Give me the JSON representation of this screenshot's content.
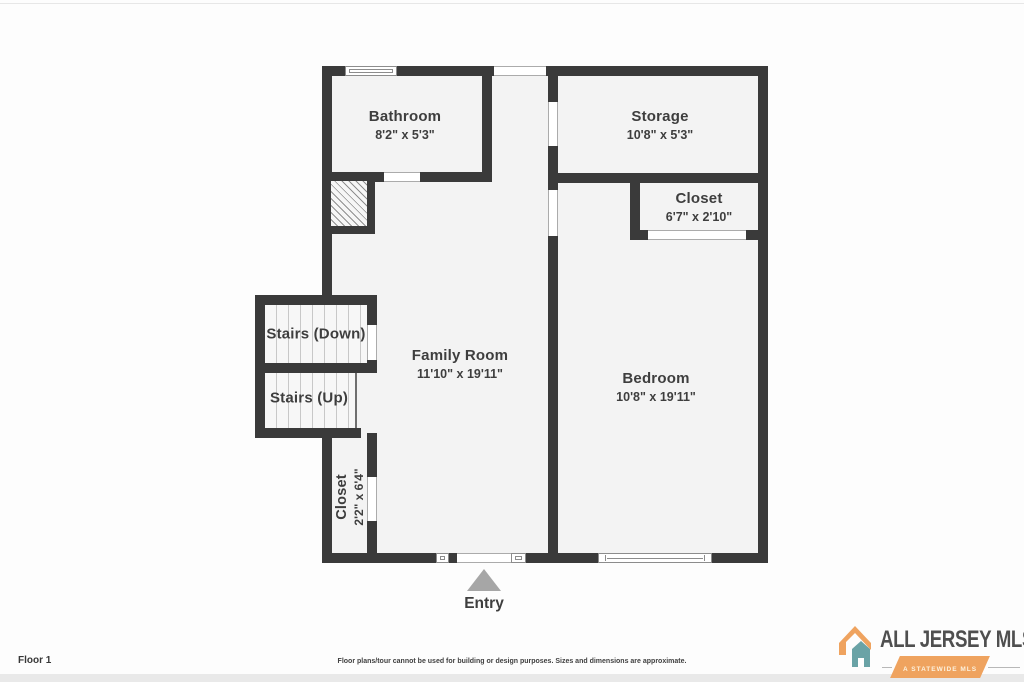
{
  "plan": {
    "entry_label": "Entry"
  },
  "rooms": {
    "bathroom": {
      "name": "Bathroom",
      "dims": "8'2\" x 5'3\""
    },
    "storage": {
      "name": "Storage",
      "dims": "10'8\" x 5'3\""
    },
    "closet_right": {
      "name": "Closet",
      "dims": "6'7\" x 2'10\""
    },
    "family_room": {
      "name": "Family Room",
      "dims": "11'10\" x 19'11\""
    },
    "bedroom": {
      "name": "Bedroom",
      "dims": "10'8\" x 19'11\""
    },
    "stairs_down": {
      "name": "Stairs (Down)"
    },
    "stairs_up": {
      "name": "Stairs (Up)"
    },
    "closet_left": {
      "name": "Closet",
      "dims": "2'2\" x 6'4\""
    }
  },
  "footer": {
    "floor_label": "Floor 1",
    "disclaimer": "Floor plans/tour cannot be used for building or design purposes. Sizes and dimensions are approximate."
  },
  "branding": {
    "logo_text": "ALL JERSEY MLS",
    "logo_tagline": "A STATEWIDE MLS"
  },
  "colors": {
    "wall": "#3A3A3A",
    "room_fill": "#F3F3F3",
    "text": "#3E3E3E",
    "entry_arrow": "#A6A6A6",
    "logo_orange": "#EFA35F",
    "logo_teal": "#6AA3A6",
    "logo_text_color": "#4F4F4F"
  }
}
